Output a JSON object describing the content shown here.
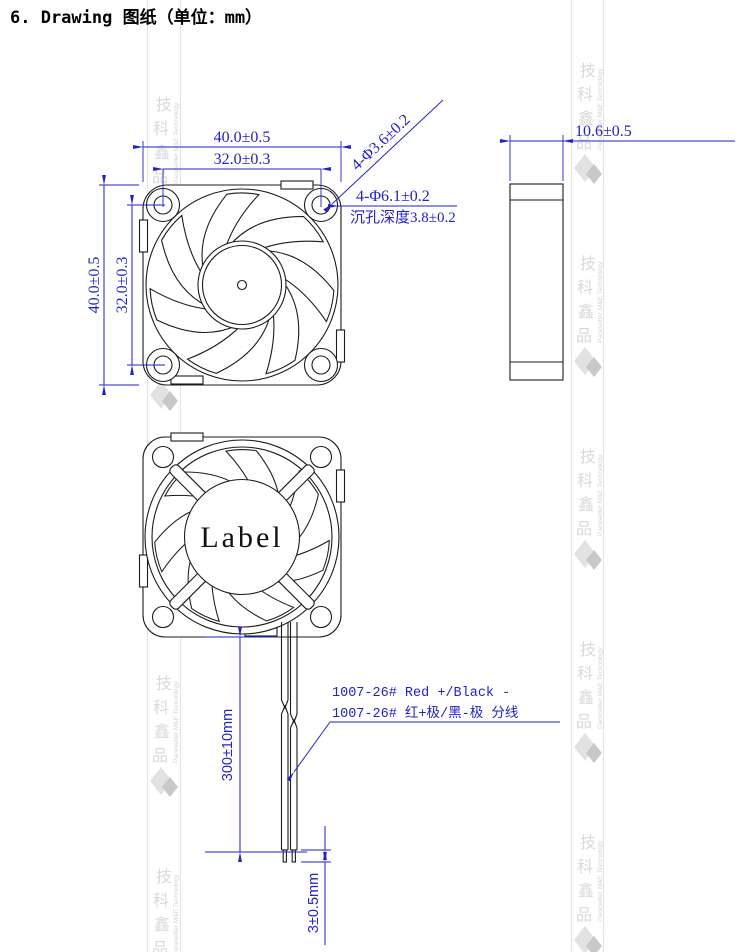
{
  "page": {
    "title": "6. Drawing 图纸（单位：mm）"
  },
  "front_view": {
    "dim_width_outer": "40.0±0.5",
    "dim_width_inner": "32.0±0.3",
    "dim_height_outer": "40.0±0.5",
    "dim_height_inner": "32.0±0.3",
    "dim_hole_diameter": "4-Φ3.6±0.2",
    "dim_counterbore": "4-Φ6.1±0.2",
    "dim_counterbore_depth": "沉孔深度3.8±0.2"
  },
  "side_view": {
    "dim_thickness": "10.6±0.5"
  },
  "rear_view": {
    "hub_label": "Label",
    "dim_wire_length": "300±10mm",
    "dim_strip_length": "3±0.5mm",
    "wire_spec_en": "1007-26# Red +/Black -",
    "wire_spec_cn": "1007-26# 红+极/黑-极 分线"
  },
  "watermark": {
    "chars": [
      "技",
      "科",
      "鑫",
      "品"
    ],
    "company_en": "Pacesetter M&E Technology"
  },
  "colors": {
    "dimension_blue": "#2222c6",
    "drawing_line": "#1b1b1b",
    "watermark_gray": "#d9d9d9",
    "background": "#ffffff"
  }
}
